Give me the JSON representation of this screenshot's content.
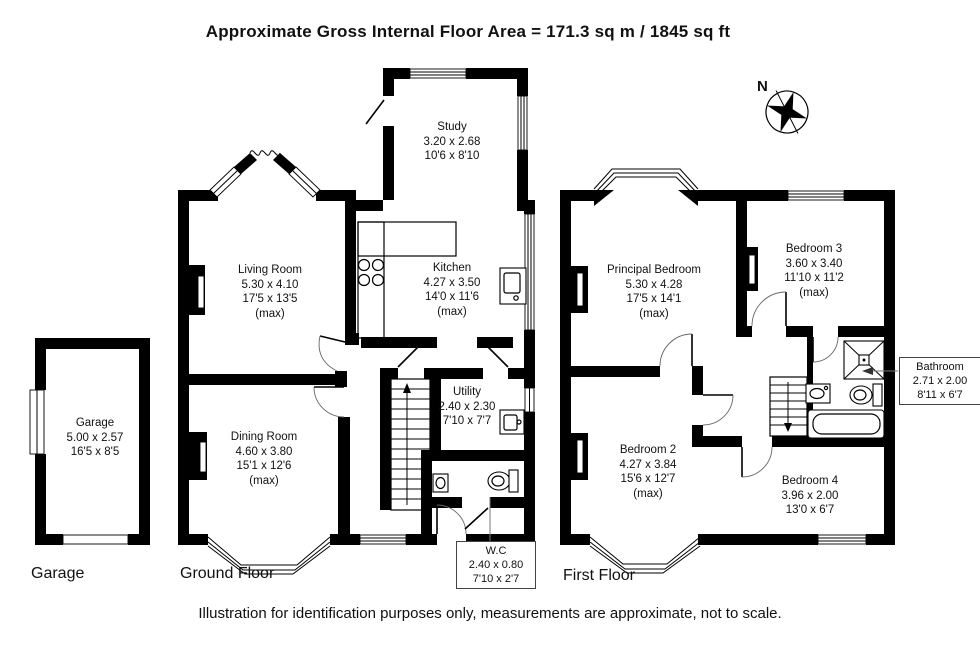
{
  "title": "Approximate Gross Internal Floor Area = 171.3 sq m / 1845 sq ft",
  "disclaimer": "Illustration for identification purposes only, measurements are approximate, not to scale.",
  "compass": {
    "north_label": "N"
  },
  "floor_labels": {
    "garage": "Garage",
    "ground": "Ground Floor",
    "first": "First Floor"
  },
  "rooms": {
    "study": {
      "name": "Study",
      "metric": "3.20 x 2.68",
      "imperial": "10'6 x 8'10"
    },
    "living": {
      "name": "Living Room",
      "metric": "5.30 x 4.10",
      "imperial": "17'5 x 13'5",
      "max": "(max)"
    },
    "kitchen": {
      "name": "Kitchen",
      "metric": "4.27 x 3.50",
      "imperial": "14'0 x 11'6",
      "max": "(max)"
    },
    "garage": {
      "name": "Garage",
      "metric": "5.00 x 2.57",
      "imperial": "16'5 x 8'5"
    },
    "dining": {
      "name": "Dining Room",
      "metric": "4.60 x 3.80",
      "imperial": "15'1 x 12'6",
      "max": "(max)"
    },
    "utility": {
      "name": "Utility",
      "metric": "2.40 x 2.30",
      "imperial": "7'10 x 7'7"
    },
    "wc": {
      "name": "W.C",
      "metric": "2.40 x 0.80",
      "imperial": "7'10 x 2'7"
    },
    "principal": {
      "name": "Principal Bedroom",
      "metric": "5.30 x 4.28",
      "imperial": "17'5 x 14'1",
      "max": "(max)"
    },
    "bed3": {
      "name": "Bedroom 3",
      "metric": "3.60 x 3.40",
      "imperial": "11'10 x 11'2",
      "max": "(max)"
    },
    "bathroom": {
      "name": "Bathroom",
      "metric": "2.71 x 2.00",
      "imperial": "8'11 x 6'7"
    },
    "bed2": {
      "name": "Bedroom 2",
      "metric": "4.27 x 3.84",
      "imperial": "15'6 x 12'7",
      "max": "(max)"
    },
    "bed4": {
      "name": "Bedroom 4",
      "metric": "3.96 x 2.00",
      "imperial": "13'0 x 6'7"
    }
  }
}
